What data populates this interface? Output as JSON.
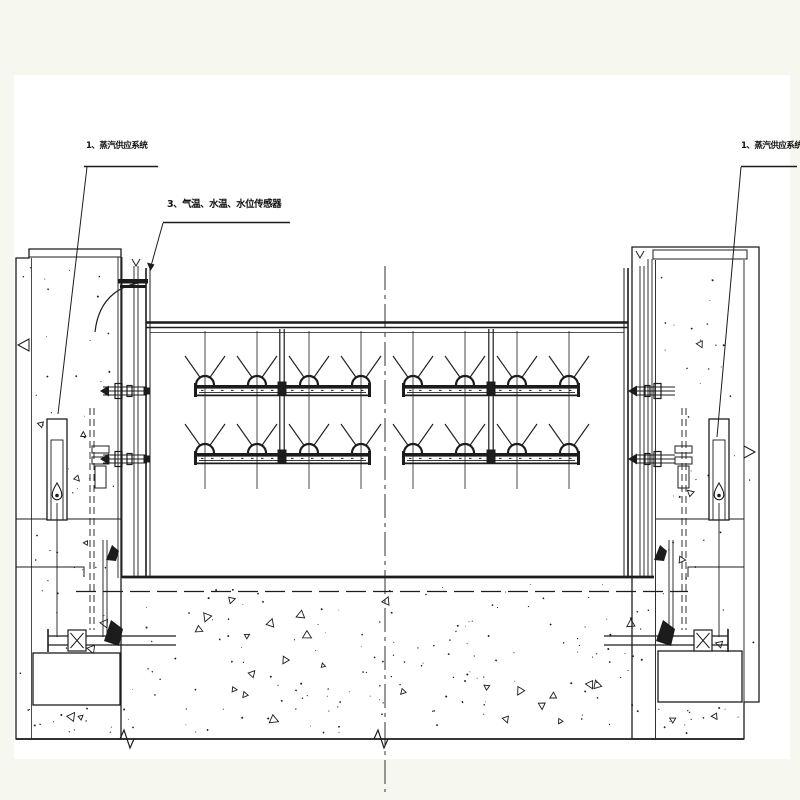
{
  "canvas": {
    "background_color": "#f6f8f0",
    "paper_color": "#ffffff",
    "ink_color": "#1c1c1c"
  },
  "labels": {
    "left_steam": "1、蒸汽供应系统",
    "sensors": "3、气温、水温、水位传感器",
    "right_steam": "1、蒸汽供应系统"
  }
}
